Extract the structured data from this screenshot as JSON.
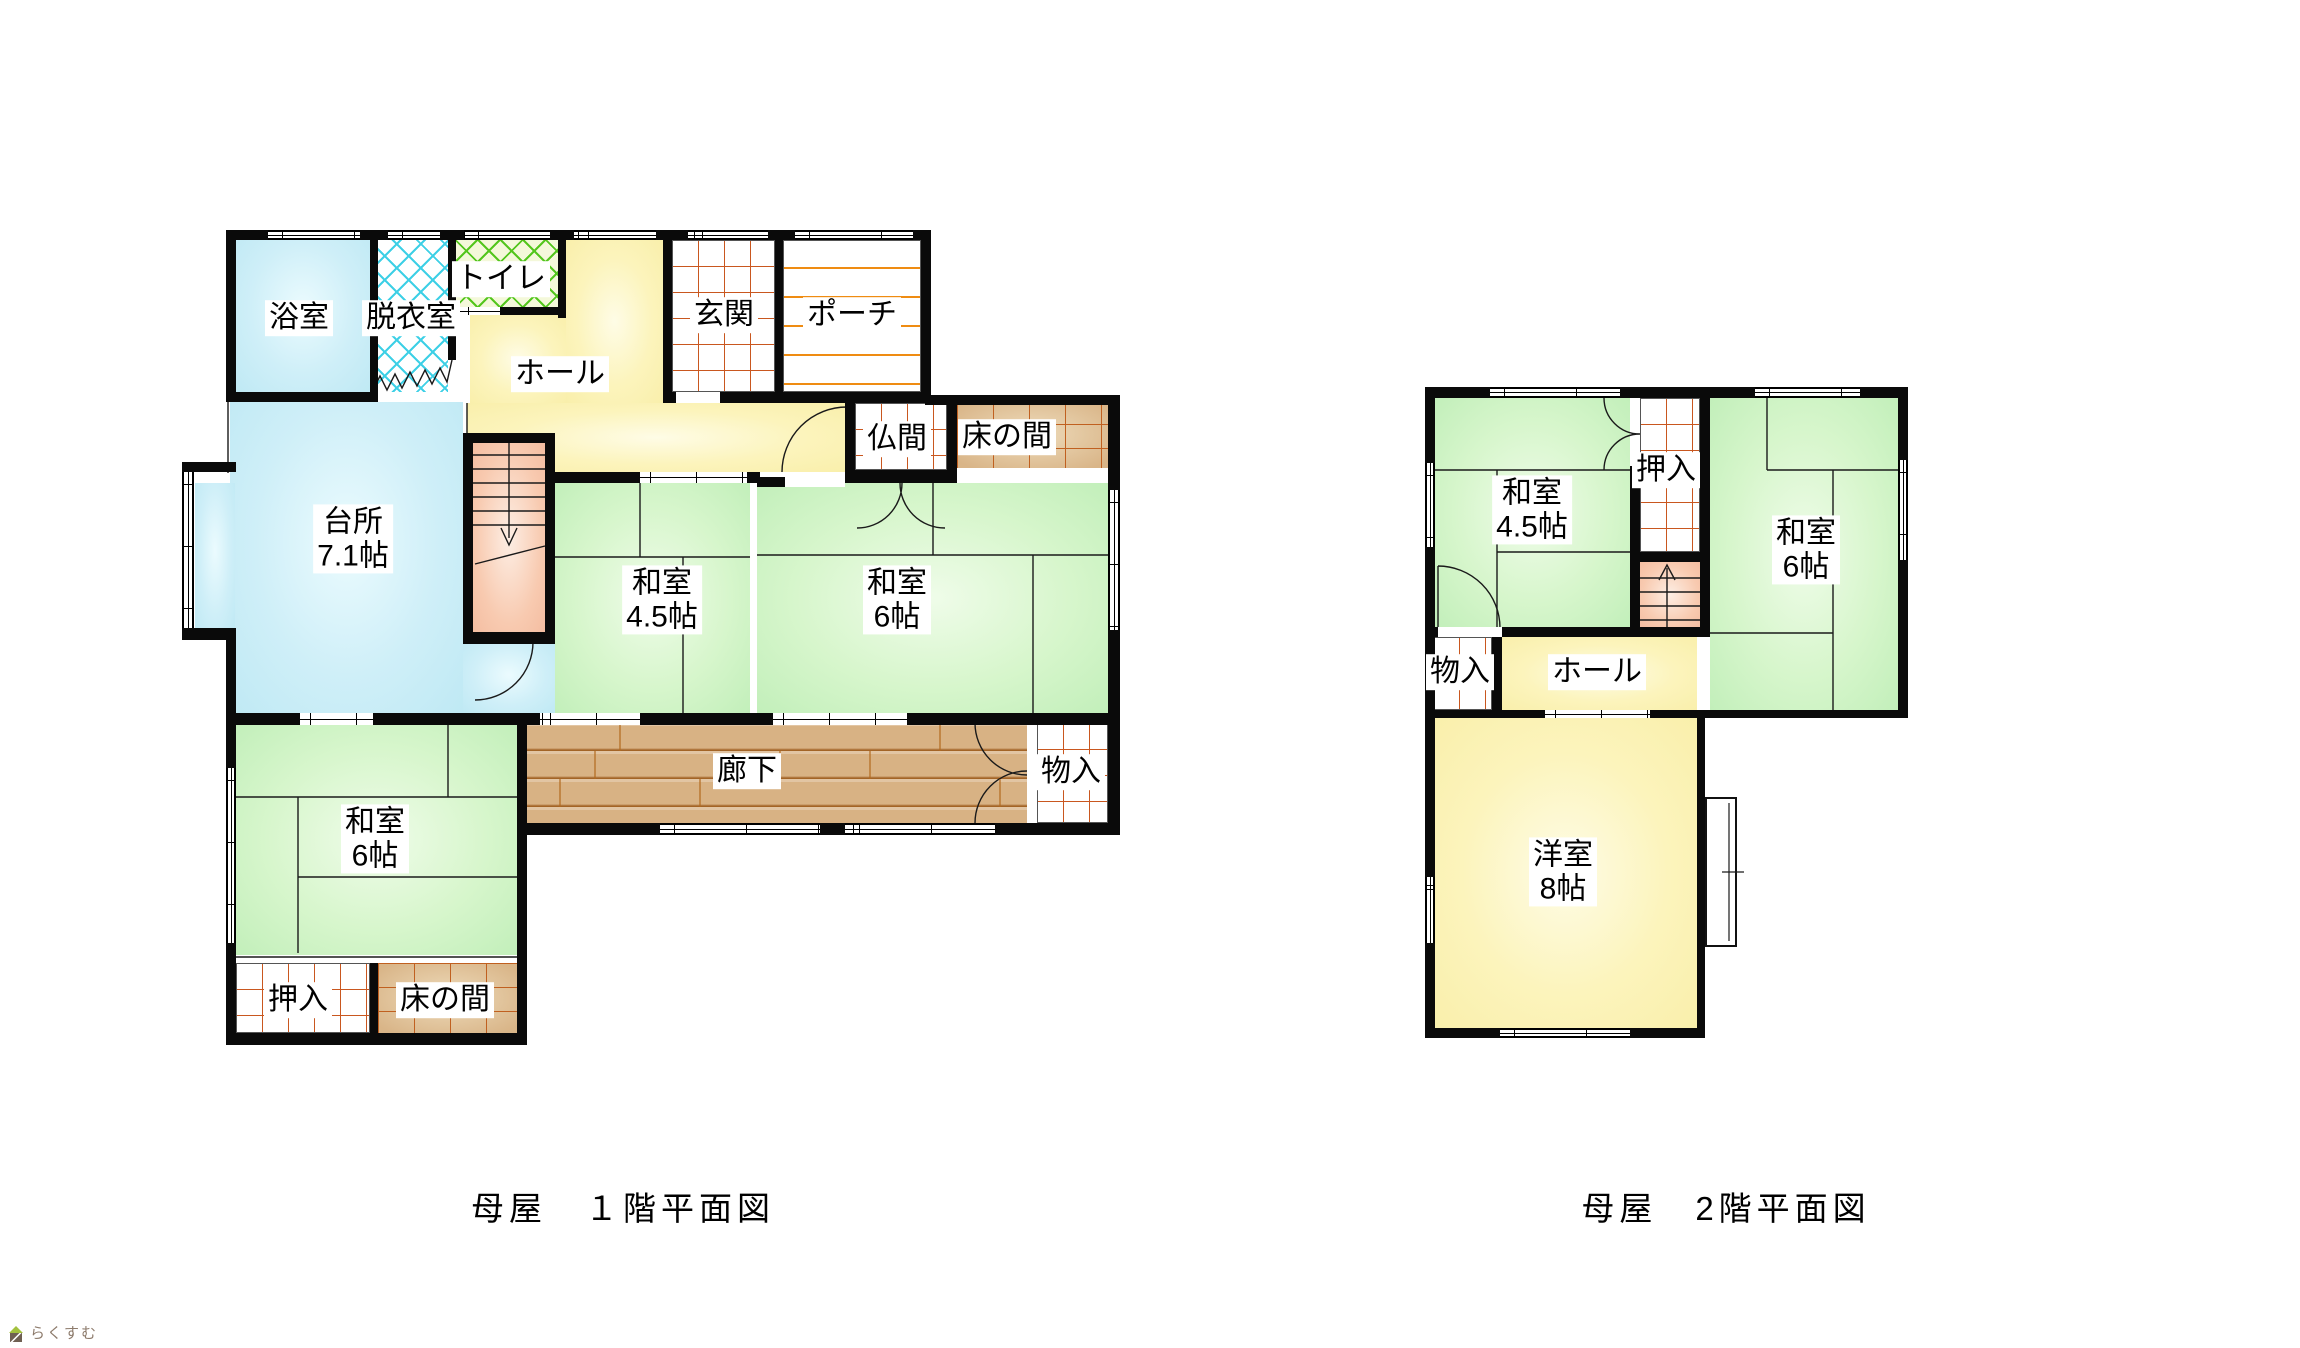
{
  "page": {
    "background": "#ffffff"
  },
  "watermark": {
    "text": "らくすむ"
  },
  "floor1": {
    "caption": "母屋　１階平面図",
    "rooms": {
      "bath": {
        "label": "浴室"
      },
      "dressing": {
        "label": "脱衣室"
      },
      "toilet": {
        "label": "トイレ"
      },
      "hall": {
        "label": "ホール"
      },
      "entrance": {
        "label": "玄関"
      },
      "porch": {
        "label": "ポーチ"
      },
      "butsuma": {
        "label": "仏間"
      },
      "tokonoma_upper": {
        "label": "床の間"
      },
      "kitchen": {
        "label": "台所",
        "size": "7.1帖"
      },
      "washitsu_45": {
        "label": "和室",
        "size": "4.5帖"
      },
      "washitsu_6_east": {
        "label": "和室",
        "size": "6帖"
      },
      "corridor": {
        "label": "廊下"
      },
      "storage": {
        "label": "物入"
      },
      "washitsu_6_south": {
        "label": "和室",
        "size": "6帖"
      },
      "oshiire": {
        "label": "押入"
      },
      "tokonoma_lower": {
        "label": "床の間"
      }
    }
  },
  "floor2": {
    "caption": "母屋　2階平面図",
    "rooms": {
      "washitsu_45": {
        "label": "和室",
        "size": "4.5帖"
      },
      "oshiire": {
        "label": "押入"
      },
      "washitsu_6": {
        "label": "和室",
        "size": "6帖"
      },
      "storage": {
        "label": "物入"
      },
      "hall": {
        "label": "ホール"
      },
      "youshitsu": {
        "label": "洋室",
        "size": "8帖"
      }
    }
  },
  "colors": {
    "wall": "#0a0a0a",
    "tatami_green": "#cdf2c3",
    "water_blue": "#c9eef8",
    "hall_yellow": "#fbf2b4",
    "corridor_wood": "#d8b284",
    "stairs_salmon": "#f6c5aa",
    "grid_line_orange": "#c9571f",
    "porch_line_orange": "#ef8c12",
    "hatch_cyan": "#3ed0e6",
    "hatch_green": "#54c61e",
    "tokonoma_tan": "#d9b588"
  }
}
